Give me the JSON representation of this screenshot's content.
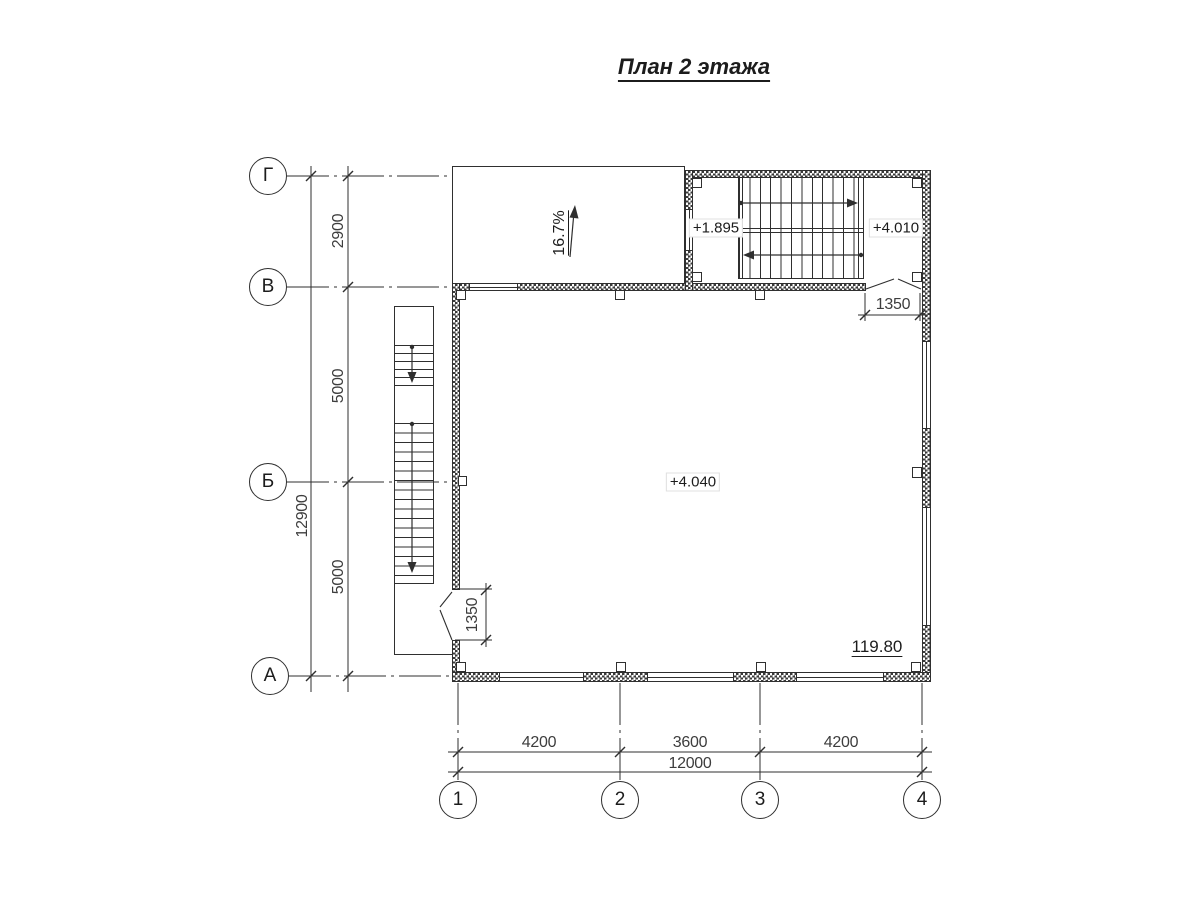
{
  "title": "План 2 этажа",
  "axes": {
    "rows": [
      {
        "label": "Г"
      },
      {
        "label": "В"
      },
      {
        "label": "Б"
      },
      {
        "label": "А"
      }
    ],
    "cols": [
      {
        "label": "1"
      },
      {
        "label": "2"
      },
      {
        "label": "3"
      },
      {
        "label": "4"
      }
    ]
  },
  "dims": {
    "left_total": "12900",
    "left_seg_gv": "2900",
    "left_seg_vb": "5000",
    "left_seg_ba": "5000",
    "bottom_12": "4200",
    "bottom_23": "3600",
    "bottom_34": "4200",
    "bottom_total": "12000",
    "stair_door": "1350",
    "left_door": "1350"
  },
  "marks": {
    "slope": "16.7%",
    "landing_mid": "+1.895",
    "landing_top": "+4.010",
    "floor_level": "+4.040",
    "area": "119.80"
  },
  "colors": {
    "ink": "#2f2f2f",
    "dim_text": "#3d3d3d",
    "paper": "#ffffff"
  }
}
